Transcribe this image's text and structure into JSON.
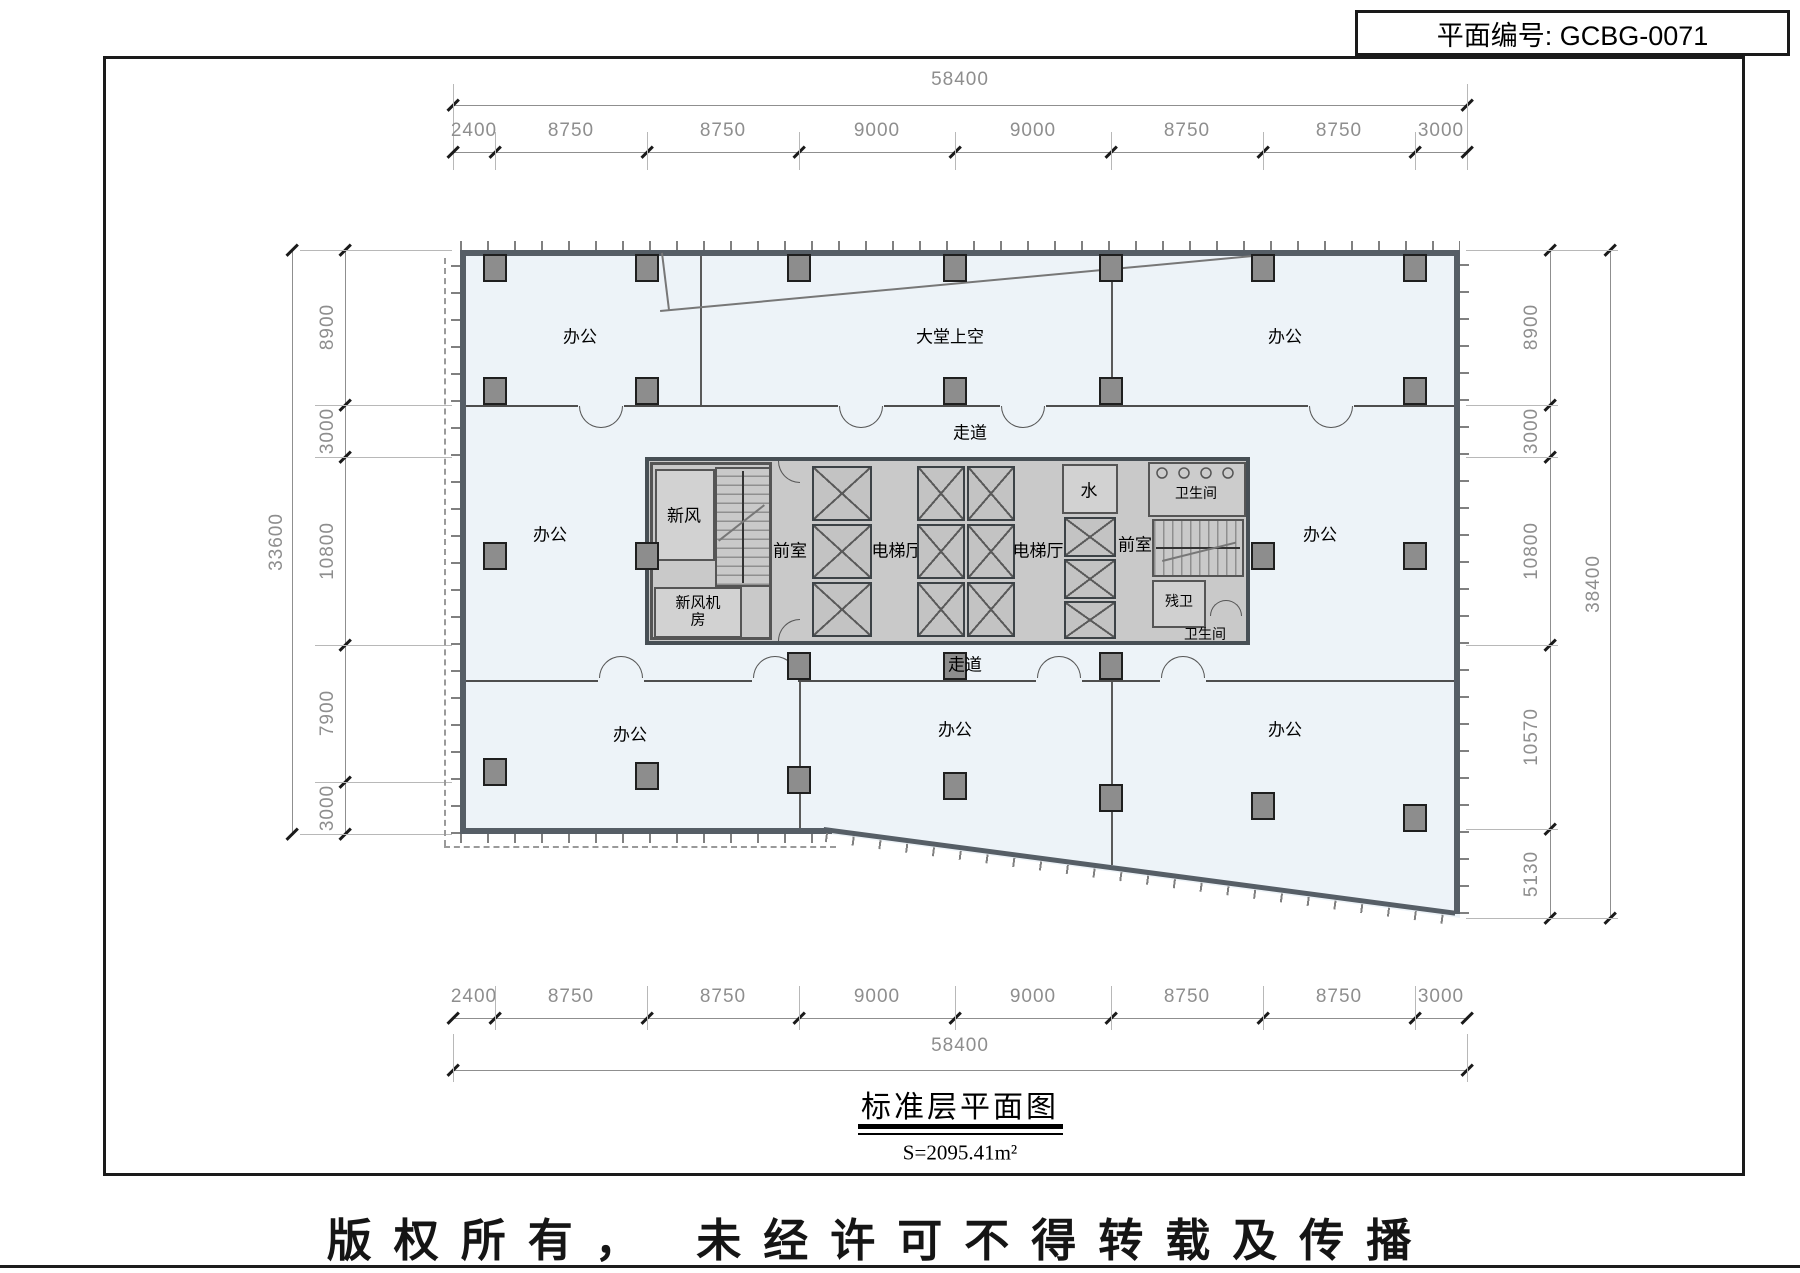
{
  "title_block": {
    "plan_no": "平面编号: GCBG-0071"
  },
  "sheet": {
    "title": "标准层平面图",
    "area": "S=2095.41m²",
    "copyright": "版权所有， 未经许可不得转载及传播"
  },
  "dims": {
    "top": {
      "total": "58400",
      "segments": [
        "2400",
        "8750",
        "8750",
        "9000",
        "9000",
        "8750",
        "8750",
        "3000"
      ]
    },
    "bottom": {
      "total": "58400",
      "segments": [
        "2400",
        "8750",
        "8750",
        "9000",
        "9000",
        "8750",
        "8750",
        "3000"
      ]
    },
    "left": {
      "total": "33600",
      "segments": [
        "8900",
        "3000",
        "10800",
        "7900",
        "3000"
      ]
    },
    "right": {
      "total": "38400",
      "segments": [
        "8900",
        "3000",
        "10800",
        "10570",
        "5130"
      ]
    }
  },
  "rooms": {
    "office": "办公",
    "lobby_void": "大堂上空",
    "corridor": "走道",
    "fresh_air": "新风",
    "fresh_air_plant": "新风机房",
    "anteroom": "前室",
    "elevator_hall": "电梯厅",
    "water": "水",
    "toilet": "卫生间",
    "accessible_toilet": "残卫"
  },
  "colors": {
    "floor": "#edf3f8",
    "core": "#c9c9c9",
    "wall": "#565e66",
    "column": "#8d8d8d",
    "dim_text": "#8e8e8e",
    "line": "#000000"
  }
}
